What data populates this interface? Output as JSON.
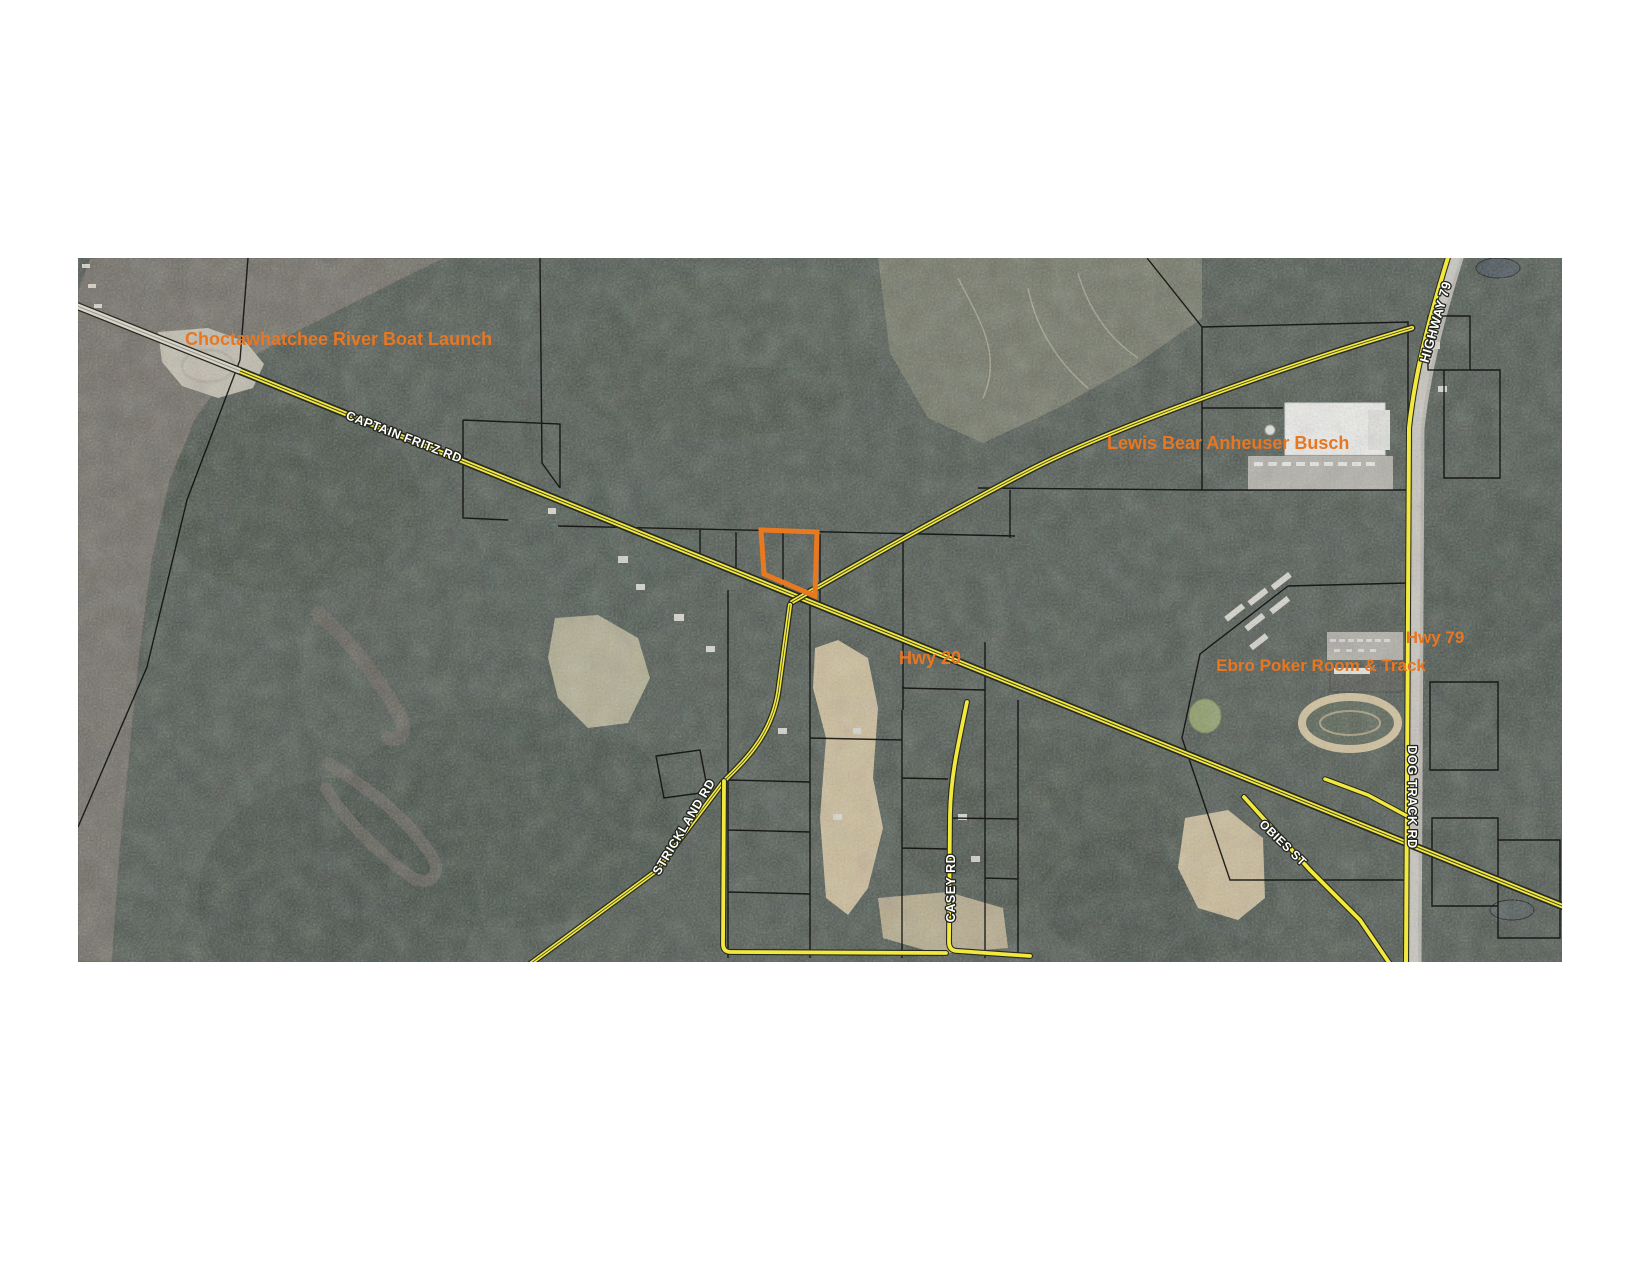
{
  "map": {
    "poi_labels": [
      {
        "name": "choctawhatchee-river-boat-launch",
        "text": "Choctawhatchee River Boat Launch"
      },
      {
        "name": "lewis-bear-anheuser-busch",
        "text": "Lewis Bear Anheuser Busch"
      },
      {
        "name": "hwy-20",
        "text": "Hwy 20"
      },
      {
        "name": "hwy-79",
        "text": "Hwy 79"
      },
      {
        "name": "ebro-poker-room-and-track",
        "text": "Ebro Poker Room & Track"
      }
    ],
    "road_labels": [
      {
        "name": "captain-fritz-rd",
        "text": "CAPTAIN FRITZ RD"
      },
      {
        "name": "highway-79",
        "text": "HIGHWAY 79"
      },
      {
        "name": "strickland-rd",
        "text": "STRICKLAND RD"
      },
      {
        "name": "casey-rd",
        "text": "CASEY RD"
      },
      {
        "name": "obies-st",
        "text": "OBIES ST"
      },
      {
        "name": "dog-track-rd",
        "text": "DOG TRACK RD"
      }
    ],
    "colors": {
      "poi_label": "#E87722",
      "road_yellow": "#F2E83E",
      "parcel_outline": "#E8791F",
      "water": "#6E6A61",
      "forest": "#49524A",
      "sand": "#D9C79E",
      "highway_surface": "#B7B4AC",
      "road_label_fill": "#FFFFFF",
      "road_label_halo": "#22261D",
      "boundary_line": "#0E0E0C"
    }
  }
}
